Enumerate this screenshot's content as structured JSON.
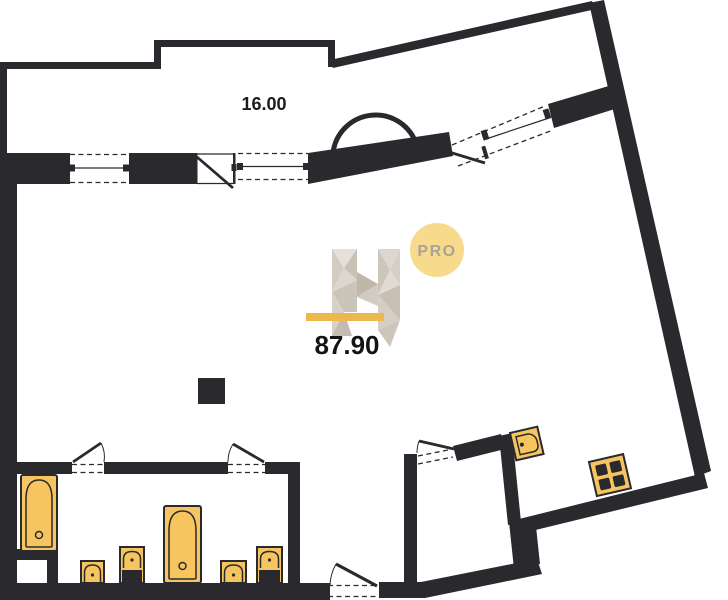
{
  "labels": {
    "balcony_area": "16.00",
    "total_area": "87.90",
    "badge": "PRO"
  },
  "colors": {
    "wall": "#2A2A2E",
    "fixture_fill": "#F6C55F",
    "accent_yellow": "#ECB84E",
    "badge_fill": "#F8DA8C",
    "badge_text": "#A9A295",
    "background": "#FFFFFF"
  },
  "floor_plan": {
    "type": "apartment-floor-plan",
    "areas": [
      {
        "name": "balcony-strip",
        "area_label": "16.00"
      },
      {
        "name": "apartment-total",
        "area_label": "87.90"
      }
    ],
    "watermark": {
      "logo": "faceted-H",
      "badge": "PRO",
      "underline_color": "#ECB84E"
    },
    "fixtures": [
      "bathtub",
      "bathtub",
      "toilet",
      "toilet",
      "pedestal-sink",
      "pedestal-sink",
      "kitchen-sink",
      "stove-4-burner",
      "column"
    ],
    "openings": {
      "windows": 3,
      "doors": 6,
      "arched_opening": 1
    }
  }
}
